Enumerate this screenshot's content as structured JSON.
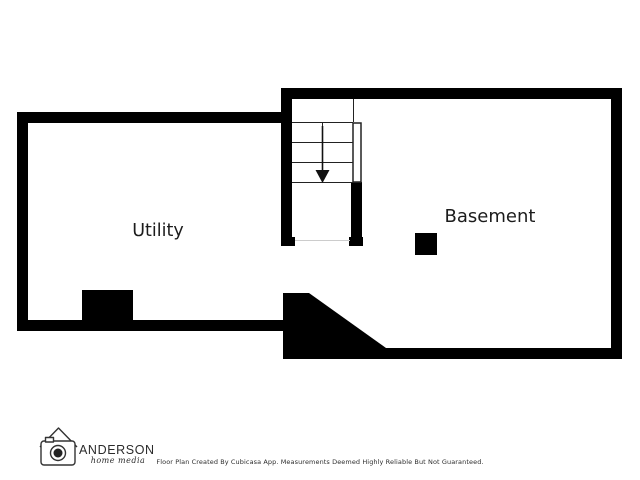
{
  "page": {
    "background": "#ffffff",
    "type": "floor-plan-screenshot"
  },
  "floor_plan": {
    "wall_color": "#000000",
    "stair_line_color": "#222222",
    "rooms": [
      {
        "name": "Utility"
      },
      {
        "name": "Basement"
      }
    ],
    "stairs": {
      "icon": "down-arrow",
      "direction": "down",
      "treads": 4,
      "flights": 2
    },
    "features": [
      "support-post-square",
      "diagonal-wall-bottom",
      "wall-notch-utility-bottom",
      "door-opening-stair-bottom",
      "door-opening-utility-to-basement"
    ]
  },
  "branding": {
    "company": "ANDERSON",
    "tagline": "home media",
    "logo_icon": "house-roof-camera"
  },
  "footer": {
    "disclaimer": "Floor Plan Created By Cubicasa App. Measurements Deemed Highly Reliable But Not Guaranteed."
  }
}
